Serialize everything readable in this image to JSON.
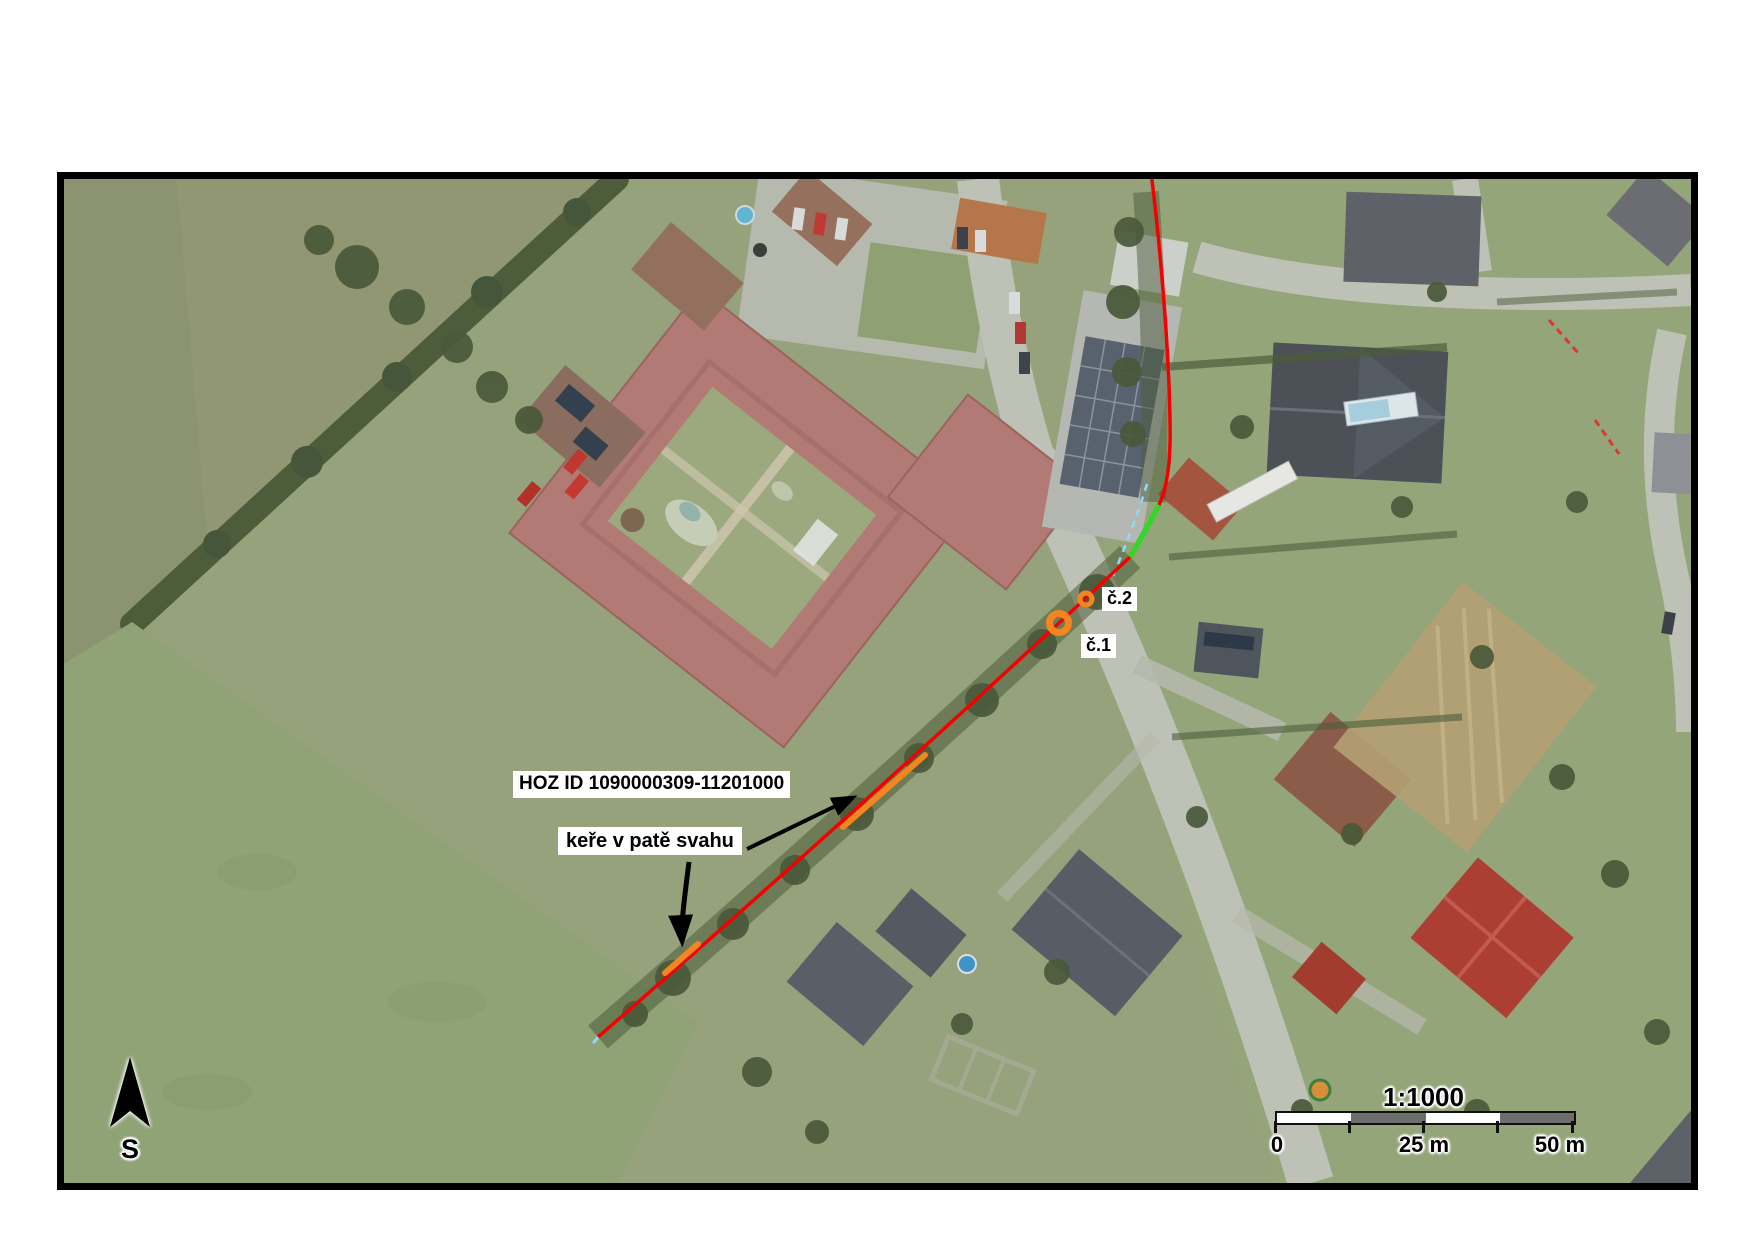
{
  "map": {
    "annotations": {
      "hoz_id_label": "HOZ ID 1090000309-11201000",
      "kere_label": "keře v patě svahu",
      "marker_1_label": "č.1",
      "marker_2_label": "č.2"
    },
    "north_arrow": {
      "label": "S"
    },
    "scale_bar": {
      "ratio": "1:1000",
      "ticks": [
        "0",
        "25 m",
        "50 m"
      ]
    }
  },
  "colors": {
    "hoz_line_red": "#f40000",
    "revitalized_green": "#38d32c",
    "orange_segment": "#f5861f",
    "orange_marker": "#f5861f",
    "water_dash_blue": "#8fd9ff",
    "scale_bar_gray": "#6e6e6e"
  }
}
